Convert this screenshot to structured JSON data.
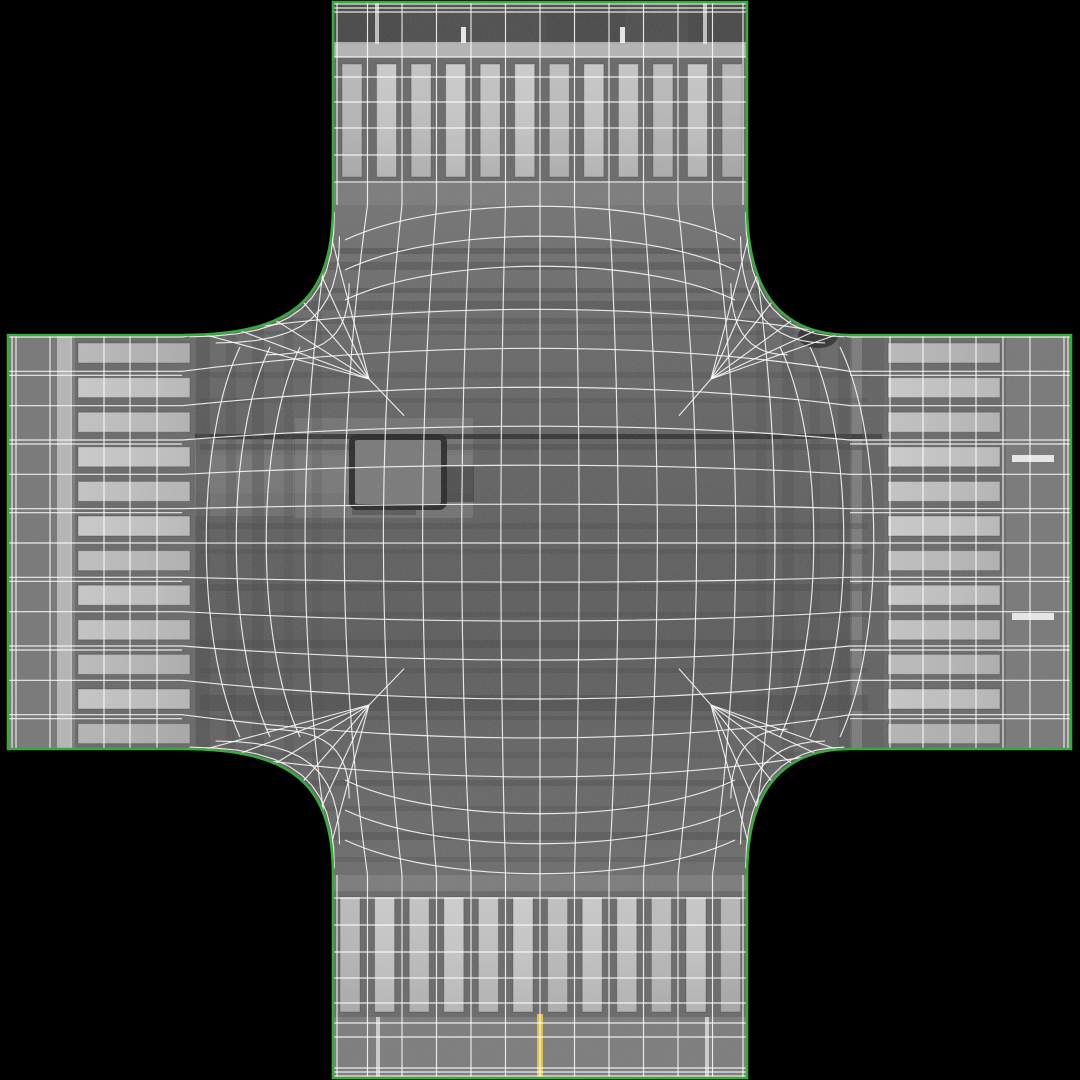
{
  "meta": {
    "kind": "3d-wireframe-texture-preview",
    "subject": "four-way road intersection with zebra crosswalks, quad wireframe overlay and green border edges",
    "background": "#000000"
  },
  "palette": {
    "outline_green": "#3aa93e",
    "wire": "#ffffff",
    "asphalt": "#767676",
    "dark_zone": "#464646",
    "stop_bar": "#b3b3b3",
    "crosswalk_bg": "#626262",
    "lane_white": "#d6d6d6",
    "dash_white": "#eaeaea",
    "yellow": "#e0c143",
    "crack": "#242424",
    "stain": "#161616",
    "patch_edge": "#1e1e1e",
    "patch_fill": "#757575",
    "streak": "#3f3f3f",
    "band_dark": "#454545",
    "shade_mid": "#6e6e6e"
  },
  "outline": {
    "v_left": 333,
    "v_right": 747,
    "h_top": 335,
    "h_bottom": 749,
    "left_edge": 8,
    "right_edge": 1071,
    "top_edge": 2,
    "bottom_edge": 1078,
    "fillet_top": 205,
    "fillet_bottom": 875,
    "fillet_left": 182,
    "fillet_right": 850
  },
  "crosswalks": {
    "top": {
      "count": 12,
      "x_start": 342,
      "pitch": 34.55,
      "w": 20,
      "y": 64,
      "len": 113,
      "bg": [
        333,
        57,
        414,
        126
      ]
    },
    "bottom": {
      "count": 12,
      "x_start": 340,
      "pitch": 34.6,
      "w": 20,
      "y": 897,
      "len": 115,
      "bg": [
        333,
        891,
        414,
        126
      ]
    },
    "left": {
      "count": 12,
      "y_start": 343,
      "pitch": 34.6,
      "h": 20,
      "x": 78,
      "len": 112,
      "bg": [
        75,
        335,
        120,
        414
      ]
    },
    "right": {
      "count": 12,
      "y_start": 343,
      "pitch": 34.6,
      "h": 20,
      "x": 888,
      "len": 112,
      "bg": [
        884,
        335,
        122,
        414
      ]
    },
    "stripe_opacities": [
      0.8,
      0.95,
      0.88,
      0.97,
      0.9,
      0.96,
      0.85,
      0.93,
      0.9,
      0.82,
      0.92,
      0.75
    ]
  },
  "markings": {
    "top_dark_zone": [
      333,
      2,
      414,
      42
    ],
    "top_dark_streaks": [
      [
        333,
        2,
        70,
        42,
        0.5
      ],
      [
        545,
        2,
        80,
        42,
        0.35
      ],
      [
        688,
        2,
        59,
        42,
        0.5
      ]
    ],
    "top_stop_bar": [
      333,
      44,
      414,
      13
    ],
    "left_stop_bar": [
      57,
      335,
      13,
      414
    ],
    "top_lane_lines": [
      [
        375,
        2,
        4,
        42
      ],
      [
        703,
        2,
        4,
        42
      ]
    ],
    "top_dashes": [
      [
        461,
        27,
        5,
        16
      ],
      [
        620,
        27,
        5,
        16
      ]
    ],
    "bottom_yellow": [
      537,
      1014,
      6,
      64
    ],
    "bottom_lane_lines": [
      [
        376,
        1017,
        4,
        61
      ],
      [
        705,
        1017,
        4,
        61
      ]
    ],
    "right_dashes": [
      [
        1012,
        455,
        42,
        7
      ],
      [
        1012,
        613,
        42,
        7
      ]
    ],
    "left_approach_shade": [
      8,
      335,
      49,
      414
    ],
    "right_exit_shade": [
      1006,
      335,
      65,
      414
    ]
  },
  "center": {
    "rect": [
      182,
      205,
      668,
      670
    ],
    "light_zones": [
      [
        182,
        455,
        290,
        38,
        0.3
      ],
      [
        295,
        418,
        178,
        100,
        0.45
      ],
      [
        182,
        440,
        112,
        76,
        0.4
      ]
    ],
    "h_streak_span": [
      200,
      668
    ],
    "h_streaks": [
      [
        248,
        6,
        0.45
      ],
      [
        262,
        8,
        0.4
      ],
      [
        288,
        5,
        0.45
      ],
      [
        301,
        9,
        0.4
      ],
      [
        318,
        6,
        0.35
      ],
      [
        331,
        4,
        0.3
      ],
      [
        372,
        6,
        0.3
      ],
      [
        398,
        5,
        0.28
      ],
      [
        444,
        6,
        0.45
      ],
      [
        523,
        6,
        0.35
      ],
      [
        549,
        5,
        0.3
      ],
      [
        584,
        7,
        0.4
      ],
      [
        612,
        5,
        0.32
      ],
      [
        640,
        8,
        0.42
      ],
      [
        668,
        5,
        0.35
      ],
      [
        695,
        16,
        0.5
      ],
      [
        716,
        4,
        0.35
      ],
      [
        752,
        6,
        0.28
      ],
      [
        780,
        6,
        0.35
      ],
      [
        806,
        5,
        0.3
      ],
      [
        832,
        8,
        0.4
      ],
      [
        857,
        5,
        0.28
      ]
    ],
    "crack": [
      182,
      434,
      700,
      5
    ],
    "v_streak_span": [
      240,
      600
    ],
    "v_streaks_left": [
      [
        196,
        14,
        0.45
      ],
      [
        226,
        10,
        0.32
      ],
      [
        252,
        12,
        0.38
      ],
      [
        284,
        9,
        0.28
      ],
      [
        312,
        10,
        0.22
      ]
    ],
    "v_streaks_right": [
      [
        756,
        10,
        0.28
      ],
      [
        782,
        12,
        0.35
      ],
      [
        810,
        10,
        0.3
      ],
      [
        838,
        14,
        0.4
      ],
      [
        862,
        24,
        0.55
      ]
    ],
    "patch": {
      "rect": [
        352,
        437,
        92,
        70
      ],
      "blob": [
        444,
        466,
        30,
        36
      ],
      "underline": [
        352,
        503,
        64,
        12
      ]
    },
    "stain": {
      "ellipses": [
        [
          838,
          310,
          36,
          24,
          0.85
        ],
        [
          818,
          336,
          20,
          12,
          0.7
        ],
        [
          861,
          296,
          14,
          10,
          0.6
        ]
      ]
    }
  },
  "wireframe": {
    "v_columns": {
      "n": 13,
      "x0": 333,
      "x1": 747,
      "doubles": [
        337,
        743
      ]
    },
    "top_rows": [
      4,
      8,
      12,
      43,
      57,
      77,
      102,
      128,
      155,
      182
    ],
    "bottom_rows": [
      1076,
      1072,
      1068,
      1037,
      1023,
      1003,
      978,
      952,
      925,
      898
    ],
    "h_rows": {
      "n": 13,
      "y0": 337,
      "y1": 749,
      "double_offset": 4
    },
    "left_columns": [
      12,
      16,
      50,
      71,
      104,
      130,
      157
    ],
    "right_columns": [
      890,
      923,
      950,
      976,
      1003,
      1030,
      1064,
      1068
    ],
    "bow": 0.18,
    "extra_rows_top": [
      240,
      270,
      300
    ],
    "extra_rows_bottom": [
      840,
      810,
      780
    ],
    "extra_cols_left": [
      240,
      270,
      300
    ],
    "extra_cols_right": [
      840,
      810,
      780
    ],
    "extra_bulge": 45,
    "hubs": {
      "tl": [
        369,
        379
      ],
      "tr": [
        711,
        379
      ],
      "bl": [
        369,
        705
      ],
      "br": [
        711,
        705
      ]
    },
    "spoke_ts": [
      0.12,
      0.3,
      0.47,
      0.64,
      0.8,
      0.93
    ],
    "ring_fracs": [
      0.55,
      0.82,
      0.96
    ]
  }
}
